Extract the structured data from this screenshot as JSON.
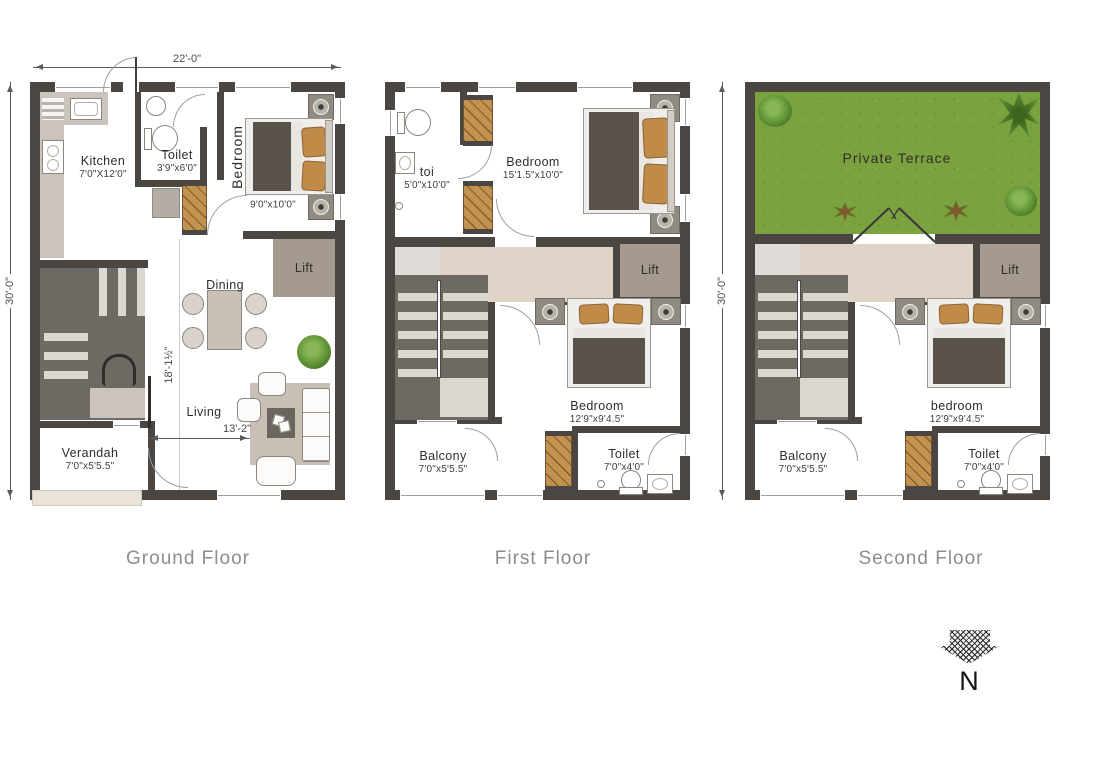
{
  "plans": {
    "ground": {
      "title": "Ground Floor",
      "dim_width": "22'-0\"",
      "dim_height": "30'-0\"",
      "dim_inner_v": "18'-1½\"",
      "dim_inner_h": "13'-2\"",
      "kitchen_name": "Kitchen",
      "kitchen_size": "7'0\"X12'0\"",
      "toilet_name": "Toilet",
      "toilet_size": "3'9\"x6'0\"",
      "bedroom_name": "Bedroom",
      "bedroom_size": "9'0\"x10'0\"",
      "dining_name": "Dining",
      "living_name": "Living",
      "lift_name": "Lift",
      "verandah_name": "Verandah",
      "verandah_size": "7'0\"x5'5.5\""
    },
    "first": {
      "title": "First Floor",
      "toi_name": "toi",
      "toi_size": "5'0\"x10'0\"",
      "bedroom1_name": "Bedroom",
      "bedroom1_size": "15'1.5\"x10'0\"",
      "bedroom2_name": "Bedroom",
      "bedroom2_size": "12'9\"x9'4.5\"",
      "balcony_name": "Balcony",
      "balcony_size": "7'0\"x5'5.5\"",
      "toilet_name": "Toilet",
      "toilet_size": "7'0\"x4'0\"",
      "lift_name": "Lift"
    },
    "second": {
      "title": "Second Floor",
      "dim_height": "30'-0\"",
      "terrace_name": "Private Terrace",
      "bedroom_name": "bedroom",
      "bedroom_size": "12'9\"x9'4.5\"",
      "balcony_name": "Balcony",
      "balcony_size": "7'0\"x5'5.5\"",
      "toilet_name": "Toilet",
      "toilet_size": "7'0\"x4'0\"",
      "lift_name": "Lift"
    }
  },
  "compass": {
    "label": "N"
  },
  "colors": {
    "wall": "#4b4642",
    "grass": "#7ba23e",
    "wood": "#c3924f",
    "lift": "#a49a8e",
    "corridor": "#ded5c8",
    "stair_dark": "#6f6963",
    "stair_light": "#dcd7d0",
    "counter": "#cbc4bc",
    "duvet": "#5a534b",
    "pillow": "#c08a48",
    "title_gray": "#8d8d8d",
    "ink": "#2f2d2b"
  }
}
